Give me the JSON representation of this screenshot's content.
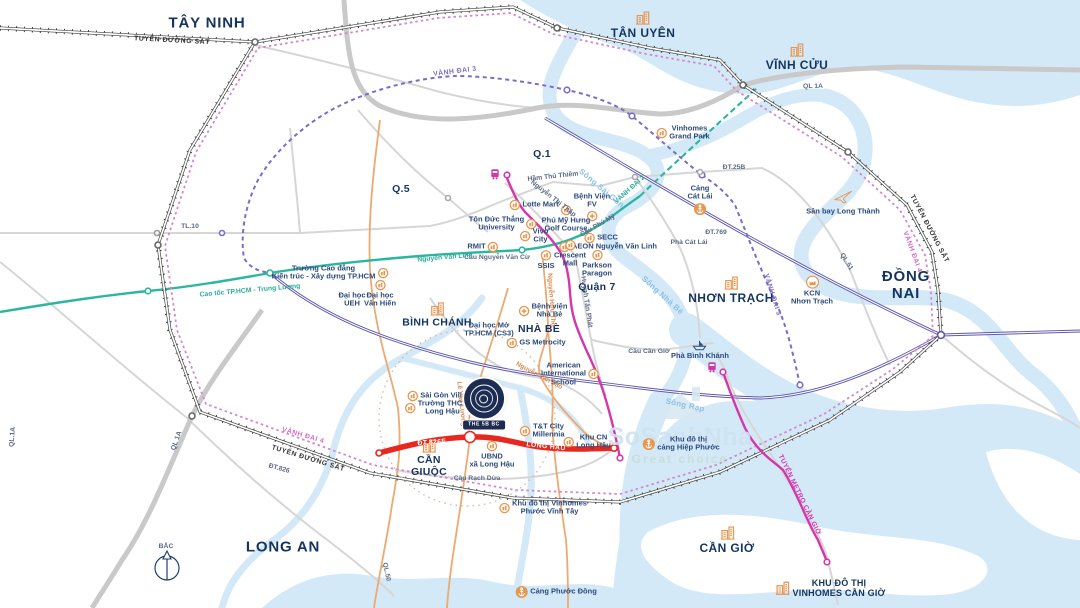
{
  "map": {
    "title_hint": "HCMC area project location map",
    "colors": {
      "water": "#d3e9f8",
      "navy_text": "#14345f",
      "poi_text": "#2c4a7c",
      "orange_icon": "#e8964f",
      "ring2_teal": "#2cb6a0",
      "ring3_purple": "#7b6cca",
      "ring4_pink": "#d387cd",
      "railway": "#3b3b3b",
      "expressway": "#5f58ad",
      "metro": "#d636ab",
      "red_road": "#e8281e",
      "gray_road": "#d6d6d6"
    },
    "watermark": {
      "brand": "SoSanhNha",
      "tagline": "Great choice"
    },
    "project_logo": {
      "label": "THE 5B BC"
    },
    "labels": [
      {
        "name": "region-tay-ninh",
        "text": "TÂY NINH",
        "x": 207,
        "y": 24,
        "cls": "region"
      },
      {
        "name": "district-tan-uyen",
        "text": "TÂN UYÊN",
        "x": 643,
        "y": 25,
        "cls": "district",
        "icon": "bld",
        "ipos": "t"
      },
      {
        "name": "district-vinh-cuu",
        "text": "VĨNH CỬU",
        "x": 797,
        "y": 57,
        "cls": "district",
        "icon": "bld",
        "ipos": "t"
      },
      {
        "name": "region-dong-nai",
        "text": "ĐỒNG\nNAI",
        "x": 906,
        "y": 286,
        "cls": "region"
      },
      {
        "name": "district-nhon-trach",
        "text": "NHƠN TRẠCH",
        "x": 731,
        "y": 290,
        "cls": "district",
        "icon": "bld",
        "ipos": "t"
      },
      {
        "name": "region-long-an",
        "text": "LONG AN",
        "x": 283,
        "y": 548,
        "cls": "region"
      },
      {
        "name": "district-can-gio",
        "text": "CẦN GIỜ",
        "x": 727,
        "y": 540,
        "cls": "district",
        "icon": "bld",
        "ipos": "t"
      },
      {
        "name": "district-can-giuoc",
        "text": "CẦN\nGIUỘC",
        "x": 429,
        "y": 458,
        "cls": "district-sm",
        "icon": "bld",
        "ipos": "t"
      },
      {
        "name": "district-binh-chanh",
        "text": "BÌNH CHÁNH",
        "x": 437,
        "y": 315,
        "cls": "district-sm",
        "icon": "bld",
        "ipos": "t"
      },
      {
        "name": "district-nha-be",
        "text": "NHÀ BÈ",
        "x": 539,
        "y": 330,
        "cls": "district-sm"
      },
      {
        "name": "district-quan-7",
        "text": "Quận 7",
        "x": 597,
        "y": 288,
        "cls": "district-sm"
      },
      {
        "name": "district-q1",
        "text": "Q.1",
        "x": 542,
        "y": 155,
        "cls": "district-sm"
      },
      {
        "name": "district-q5",
        "text": "Q.5",
        "x": 401,
        "y": 190,
        "cls": "district-sm"
      },
      {
        "name": "poi-lotte-mart",
        "text": "Lotte Mart",
        "x": 534,
        "y": 205,
        "cls": "poi",
        "icon": "poi",
        "ipos": "l"
      },
      {
        "name": "poi-ton-duc-thang",
        "text": "Tôn Đức Thắng\nUniversity",
        "x": 503,
        "y": 224,
        "cls": "poi",
        "icon": "poi",
        "ipos": "r"
      },
      {
        "name": "poi-rmit",
        "text": "RMIT",
        "x": 483,
        "y": 247,
        "cls": "poi",
        "icon": "poi",
        "ipos": "r"
      },
      {
        "name": "poi-vivo-city",
        "text": "Vivo\nCity",
        "x": 534,
        "y": 236,
        "cls": "poi",
        "icon": "poi",
        "ipos": "l"
      },
      {
        "name": "poi-secc",
        "text": "SECC",
        "x": 601,
        "y": 238,
        "cls": "poi",
        "icon": "poi",
        "ipos": "l"
      },
      {
        "name": "poi-aeon",
        "text": "AEON Nguyễn Văn Linh",
        "x": 608,
        "y": 247,
        "cls": "poi",
        "icon": "poi",
        "ipos": "l"
      },
      {
        "name": "poi-crescent-mall",
        "text": "Crescent\nMall",
        "x": 570,
        "y": 254,
        "cls": "poi",
        "icon": "poi",
        "ipos": "t"
      },
      {
        "name": "poi-ssis",
        "text": "SSIS",
        "x": 546,
        "y": 260,
        "cls": "poi",
        "icon": "poi",
        "ipos": "t"
      },
      {
        "name": "poi-fv-hospital",
        "text": "Bệnh Viện\nFV",
        "x": 592,
        "y": 207,
        "cls": "poi",
        "icon": "cross",
        "ipos": "b"
      },
      {
        "name": "poi-parkson-paragon",
        "text": "Parkson\nParagon",
        "x": 597,
        "y": 264,
        "cls": "poi",
        "icon": "poi",
        "ipos": "t"
      },
      {
        "name": "poi-pmh-golf",
        "text": "Phú Mỹ Hưng\nGolf Course",
        "x": 566,
        "y": 219,
        "cls": "poi",
        "icon": "poi",
        "ipos": "t"
      },
      {
        "name": "poi-vinhomes-grand-park",
        "text": "Vinhomes\nGrand Park",
        "x": 683,
        "y": 133,
        "cls": "poi",
        "icon": "poi",
        "ipos": "l"
      },
      {
        "name": "poi-cang-cat-lai",
        "text": "Cảng\nCát Lái",
        "x": 700,
        "y": 200,
        "cls": "poi",
        "icon": "anchor",
        "ipos": "b"
      },
      {
        "name": "poi-kcn-nhon-trach",
        "text": "KCN\nNhơn Trạch",
        "x": 812,
        "y": 291,
        "cls": "poi",
        "icon": "factory",
        "ipos": "t"
      },
      {
        "name": "poi-long-thanh-airport",
        "text": "Sân bay Long Thành",
        "x": 843,
        "y": 201,
        "cls": "poi",
        "icon": "plane",
        "ipos": "t"
      },
      {
        "name": "poi-pha-binh-khanh",
        "text": "Phà Bình Khánh",
        "x": 700,
        "y": 349,
        "cls": "poi",
        "icon": "boat",
        "ipos": "t"
      },
      {
        "name": "poi-bv-nha-be",
        "text": "Bệnh viện\nNhà Bè",
        "x": 543,
        "y": 311,
        "cls": "poi",
        "icon": "cross",
        "ipos": "l"
      },
      {
        "name": "poi-dh-mo",
        "text": "Đại học Mở\nTP.HCM (CS3)",
        "x": 489,
        "y": 330,
        "cls": "poi"
      },
      {
        "name": "poi-gs-metrocity",
        "text": "GS Metrocity",
        "x": 536,
        "y": 343,
        "cls": "poi",
        "icon": "poi",
        "ipos": "l"
      },
      {
        "name": "poi-ais",
        "text": "American\nInternational\nSchool",
        "x": 570,
        "y": 374,
        "cls": "poi",
        "icon": "poi",
        "ipos": "r"
      },
      {
        "name": "poi-saigon-village",
        "text": "Sài Gòn Village",
        "x": 441,
        "y": 396,
        "cls": "poi",
        "icon": "poi",
        "ipos": "l"
      },
      {
        "name": "poi-thcs-long-hau",
        "text": "Trường THCS\nLong Hậu",
        "x": 436,
        "y": 408,
        "cls": "poi",
        "icon": "poi",
        "ipos": "l"
      },
      {
        "name": "poi-ubnd-long-hau",
        "text": "UBND\nxã Long Hậu",
        "x": 492,
        "y": 455,
        "cls": "poi",
        "icon": "poi",
        "ipos": "t"
      },
      {
        "name": "poi-tt-city-millennia",
        "text": "T&T City\nMillennia",
        "x": 542,
        "y": 431,
        "cls": "poi",
        "icon": "poi",
        "ipos": "l"
      },
      {
        "name": "poi-kcn-long-hau",
        "text": "Khu CN\nLong Hậu",
        "x": 587,
        "y": 442,
        "cls": "poi",
        "icon": "poi",
        "ipos": "l"
      },
      {
        "name": "poi-hiep-phuoc",
        "text": "Khu đô thị\ncảng Hiệp Phước",
        "x": 681,
        "y": 444,
        "cls": "poi",
        "icon": "anchor",
        "ipos": "l"
      },
      {
        "name": "poi-vinhomes-pvt",
        "text": "Khu đô thị Vinhomes\nPhước Vĩnh Tây",
        "x": 543,
        "y": 508,
        "cls": "poi",
        "icon": "poi",
        "ipos": "l"
      },
      {
        "name": "poi-cang-phuoc-dong",
        "text": "Cảng Phước Đông",
        "x": 556,
        "y": 592,
        "cls": "poi",
        "icon": "anchor",
        "ipos": "l"
      },
      {
        "name": "poi-vinhomes-can-gio",
        "text": "KHU ĐÔ THỊ\nVINHOMES CẦN GIỜ",
        "x": 830,
        "y": 588,
        "cls": "poi-strong",
        "icon": "bld",
        "ipos": "l"
      },
      {
        "name": "poi-cd-kien-truc",
        "text": "Trường Cao đẳng\nKiến trúc - Xây dựng TP.HCM",
        "x": 330,
        "y": 273,
        "cls": "poi",
        "icon": "poi",
        "ipos": "r"
      },
      {
        "name": "poi-dh-ueh",
        "text": "Đại học\nUEH",
        "x": 352,
        "y": 300,
        "cls": "poi"
      },
      {
        "name": "poi-dh-van-hien",
        "text": "Đại học\nVăn Hiến",
        "x": 380,
        "y": 294,
        "cls": "poi",
        "icon": "poi",
        "ipos": "t"
      },
      {
        "name": "road-vanh-dai-3-top",
        "text": "VÀNH ĐAI 3",
        "x": 455,
        "y": 72,
        "rot": -7,
        "cls": "road-purple"
      },
      {
        "name": "road-vanh-dai-3-right",
        "text": "VÀNH ĐAI 3",
        "x": 772,
        "y": 295,
        "rot": 73,
        "cls": "road-purple"
      },
      {
        "name": "road-vanh-dai-2",
        "text": "VÀNH ĐAI 2",
        "x": 630,
        "y": 190,
        "rot": -42,
        "cls": "road-teal"
      },
      {
        "name": "road-vanh-dai-4-left",
        "text": "VÀNH ĐAI 4",
        "x": 303,
        "y": 436,
        "rot": 16,
        "cls": "road-pink"
      },
      {
        "name": "road-vanh-dai-4-right",
        "text": "VÀNH ĐAI 4",
        "x": 912,
        "y": 252,
        "rot": 70,
        "cls": "road-pink"
      },
      {
        "name": "road-railway-bottom",
        "text": "TUYẾN ĐƯỜNG SẮT",
        "x": 308,
        "y": 459,
        "rot": 17,
        "cls": "road-rail"
      },
      {
        "name": "road-railway-right",
        "text": "TUYẾN ĐƯỜNG SẮT",
        "x": 929,
        "y": 229,
        "rot": 62,
        "cls": "road-rail"
      },
      {
        "name": "road-railway-top",
        "text": "TUYẾN ĐƯỜNG SẮT",
        "x": 172,
        "y": 41,
        "rot": 3,
        "cls": "road-rail"
      },
      {
        "name": "road-ql1a-top",
        "text": "QL 1A",
        "x": 813,
        "y": 87,
        "cls": "road"
      },
      {
        "name": "road-ql1a-bottomleft",
        "text": "QL 1A",
        "x": 177,
        "y": 441,
        "rot": -70,
        "cls": "road"
      },
      {
        "name": "road-ql1a-edge",
        "text": "QL.1A",
        "x": 13,
        "y": 437,
        "rot": -85,
        "cls": "road"
      },
      {
        "name": "road-tl10",
        "text": "TL.10",
        "x": 190,
        "y": 227,
        "cls": "road"
      },
      {
        "name": "road-ql50",
        "text": "QL.50",
        "x": 386,
        "y": 572,
        "rot": 78,
        "cls": "road"
      },
      {
        "name": "road-ql51",
        "text": "QL.51",
        "x": 846,
        "y": 262,
        "rot": 58,
        "cls": "road"
      },
      {
        "name": "road-dt769",
        "text": "ĐT.769",
        "x": 716,
        "y": 233,
        "cls": "road"
      },
      {
        "name": "road-dt25b",
        "text": "ĐT.25B",
        "x": 734,
        "y": 168,
        "cls": "road"
      },
      {
        "name": "road-dt826",
        "text": "ĐT.826",
        "x": 279,
        "y": 469,
        "rot": 15,
        "cls": "road"
      },
      {
        "name": "road-nguyen-thi-thap",
        "text": "Nguyễn Thị Thập",
        "x": 553,
        "y": 199,
        "rot": 38,
        "cls": "road"
      },
      {
        "name": "road-ham-thu-thiem",
        "text": "Hầm Thủ Thiêm",
        "x": 553,
        "y": 177,
        "rot": -6,
        "cls": "road"
      },
      {
        "name": "road-huynh-tan-phat",
        "text": "Huỳnh Tấn Phát",
        "x": 586,
        "y": 302,
        "rot": 82,
        "cls": "road"
      },
      {
        "name": "road-cau-can-gio",
        "text": "Cầu Cần Giờ",
        "x": 649,
        "y": 352,
        "cls": "road"
      },
      {
        "name": "road-cau-rach-dua",
        "text": "Cầu Rạch Dừa",
        "x": 477,
        "y": 479,
        "cls": "road"
      },
      {
        "name": "road-cau-nguyen-van-cu",
        "text": "Cầu Nguyễn Văn Cừ",
        "x": 497,
        "y": 258,
        "cls": "road"
      },
      {
        "name": "road-cau-phu-my",
        "text": "Cầu Phú Mỹ",
        "x": 598,
        "y": 226,
        "rot": -30,
        "cls": "road"
      },
      {
        "name": "road-pha-cat-lai",
        "text": "Phà Cát Lái",
        "x": 689,
        "y": 243,
        "cls": "road"
      },
      {
        "name": "road-nguyen-van-linh",
        "text": "Nguyễn Văn Linh",
        "x": 445,
        "y": 258,
        "rot": -5,
        "cls": "road-teal"
      },
      {
        "name": "road-cao-toc-trung-luong",
        "text": "Cao tốc TP.HCM - Trung Lương",
        "x": 250,
        "y": 291,
        "rot": -5,
        "cls": "road-teal"
      },
      {
        "name": "road-le-van-luong",
        "text": "Lê Văn Lương",
        "x": 461,
        "y": 404,
        "rot": 84,
        "cls": "road-orange"
      },
      {
        "name": "road-nguyen-van-tao",
        "text": "Nguyễn Văn Tạo",
        "x": 539,
        "y": 376,
        "rot": 28,
        "cls": "road-orange"
      },
      {
        "name": "road-nguyen-huu-tho",
        "text": "Nguyễn Hữu Thọ",
        "x": 551,
        "y": 300,
        "rot": 86,
        "cls": "road-orange"
      },
      {
        "name": "road-long-hau",
        "text": "LONG HẬU",
        "x": 546,
        "y": 447,
        "rot": 6,
        "cls": "road-white"
      },
      {
        "name": "road-dt826e",
        "text": "ĐT.826E",
        "x": 432,
        "y": 443,
        "rot": -4,
        "cls": "road-white"
      },
      {
        "name": "road-metro-can-gio",
        "text": "TUYẾN METRO CẦN GIỜ",
        "x": 799,
        "y": 495,
        "rot": 64,
        "cls": "metro-lbl"
      },
      {
        "name": "compass-north",
        "text": "BẮC",
        "x": 166,
        "y": 547,
        "cls": "road"
      },
      {
        "name": "river-song-sai-gon",
        "text": "Sông Sài Gòn",
        "x": 601,
        "y": 189,
        "rot": 40,
        "cls": "river"
      },
      {
        "name": "river-song-nha-be",
        "text": "Sông Nhà Bè",
        "x": 662,
        "y": 296,
        "rot": 42,
        "cls": "river"
      },
      {
        "name": "river-song-rap",
        "text": "Sông Rạp",
        "x": 685,
        "y": 406,
        "rot": 12,
        "cls": "river"
      }
    ]
  }
}
